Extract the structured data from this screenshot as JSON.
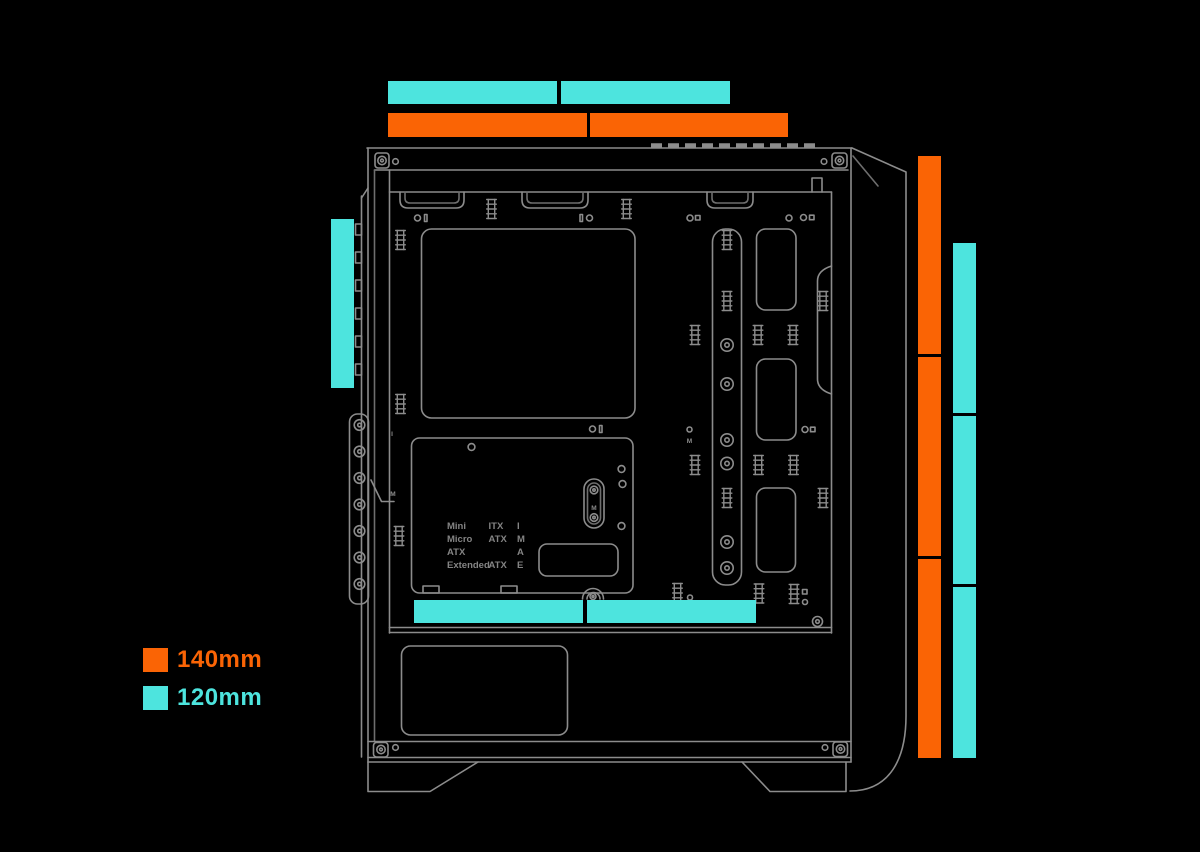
{
  "colors": {
    "background": "#000000",
    "orange": "#FA6405",
    "cyan": "#4DE4DE",
    "line": "#8C8C8C",
    "line_dim": "#6E6E6E"
  },
  "legend": {
    "items": [
      {
        "label": "140mm",
        "size_mm": 140,
        "color": "orange"
      },
      {
        "label": "120mm",
        "size_mm": 120,
        "color": "cyan"
      }
    ]
  },
  "fan_mounts": [
    {
      "id": "top-120mm",
      "size_mm": 120,
      "color": "cyan",
      "rects": [
        [
          388,
          81,
          169,
          23
        ],
        [
          561,
          81,
          169,
          23
        ]
      ]
    },
    {
      "id": "top-140mm",
      "size_mm": 140,
      "color": "orange",
      "rects": [
        [
          388,
          113,
          199,
          24
        ],
        [
          590,
          113,
          198,
          24
        ]
      ]
    },
    {
      "id": "right-140mm",
      "size_mm": 140,
      "color": "orange",
      "rects": [
        [
          918,
          156,
          23,
          198
        ],
        [
          918,
          357,
          23,
          199
        ],
        [
          918,
          559,
          23,
          199
        ]
      ]
    },
    {
      "id": "right-120mm",
      "size_mm": 120,
      "color": "cyan",
      "rects": [
        [
          953,
          243,
          23,
          170
        ],
        [
          953,
          416,
          23,
          168
        ],
        [
          953,
          587,
          23,
          171
        ]
      ]
    },
    {
      "id": "left-120mm",
      "size_mm": 120,
      "color": "cyan",
      "rects": [
        [
          331,
          219,
          23,
          169
        ]
      ]
    },
    {
      "id": "bottom-120mm",
      "size_mm": 120,
      "color": "cyan",
      "rects": [
        [
          414,
          600,
          169,
          23
        ],
        [
          587,
          600,
          169,
          23
        ]
      ]
    }
  ],
  "mobo_table": {
    "rows": [
      [
        "Mini",
        "ITX",
        "I"
      ],
      [
        "Micro",
        "ATX",
        "M"
      ],
      [
        "ATX",
        "",
        "A"
      ],
      [
        "Extended",
        "ATX",
        "E"
      ]
    ]
  },
  "markers": [
    {
      "t": "I",
      "x": 392,
      "y": 436
    },
    {
      "t": "M",
      "x": 393,
      "y": 496
    },
    {
      "t": "M",
      "x": 689.5,
      "y": 443
    },
    {
      "t": "M",
      "x": 594,
      "y": 510
    }
  ]
}
